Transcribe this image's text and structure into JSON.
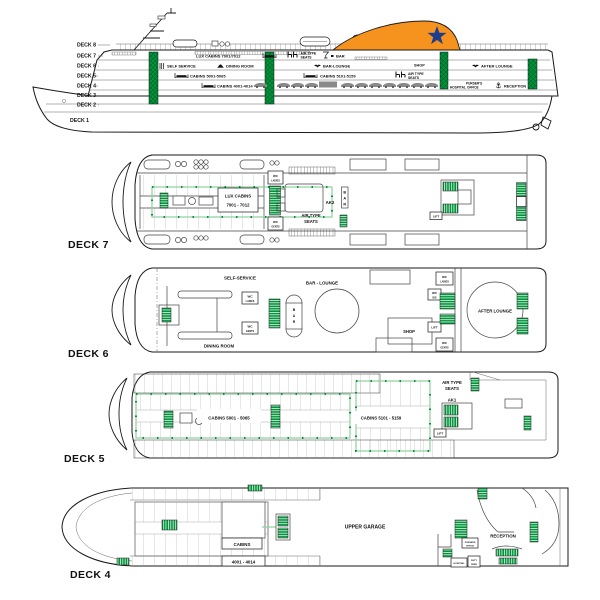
{
  "colors": {
    "stairs_green": "#00953B",
    "escape_route_pale_green": "#8FCF9F",
    "funnel_orange": "#F6921E",
    "funnel_star_blue": "#1E3D8F",
    "line": "#1a1a1a"
  },
  "profile": {
    "deck_labels": [
      "DECK 8",
      "DECK 7",
      "DECK 6",
      "DECK 5",
      "DECK 4",
      "DECK 3",
      "DECK 2",
      "DECK 1"
    ],
    "amenities": {
      "lux_cabins": "LUX CABINS 7001/7012",
      "air_type_seats_line1": "AIR TYPE",
      "air_type_seats_line2": "SEATS",
      "bar": "BAR",
      "self_service": "SELF SERVICE",
      "dining_room": "DINING ROOM",
      "bar_lounge": "BAR-LOUNGE",
      "shop": "SHOP",
      "after_lounge": "AFTER LOUNGE",
      "cabins_5001": "CABINS 5001-5065",
      "cabins_5101": "CABINS 5101-5159",
      "cabins_4001": "CABINS 4001-4014",
      "hospital": "HOSPITAL",
      "pursers_line1": "PURSER'S",
      "pursers_line2": "OFFICE",
      "reception": "RECEPTION"
    }
  },
  "wc": {
    "wc": "WC",
    "ladies": "LADIES",
    "gents": "GENTS",
    "dis": "DIS"
  },
  "deck7": {
    "title": "DECK 7",
    "lux_cabins_line1": "LUX CABINS",
    "lux_cabins_line2": "7001 - 7012",
    "ak2": "AK2",
    "bar_letters": [
      "B",
      "A",
      "R"
    ],
    "air_type_line1": "AIR TYPE",
    "air_type_line2": "SEATS",
    "lift": "LIFT"
  },
  "deck6": {
    "title": "DECK 6",
    "self_service": "SELF-SERVICE",
    "bar_lounge": "BAR - LOUNGE",
    "dining_room": "DINING ROOM",
    "bar_letters": [
      "B",
      "A",
      "R"
    ],
    "shop": "SHOP",
    "lift": "LIFT",
    "after_lounge": "AFTER LOUNGE"
  },
  "deck5": {
    "title": "DECK 5",
    "cabins_a": "CABINS 5001 - 5065",
    "cabins_b": "CABINS 5101 - 5159",
    "air_type_line1": "AIR TYPE",
    "air_type_line2": "SEATS",
    "ak1": "AK1",
    "lift": "LIFT"
  },
  "deck4": {
    "title": "DECK 4",
    "cabins": "CABINS",
    "cabins_range": "4001 - 4014",
    "upper_garage": "UPPER GARAGE",
    "reception": "RECEPTION",
    "pursers_line1": "PURSERS",
    "pursers_line2": "OFFICE",
    "hospital": "HOSPITAL",
    "duty_line1": "DUTY",
    "duty_line2": "FREE"
  }
}
